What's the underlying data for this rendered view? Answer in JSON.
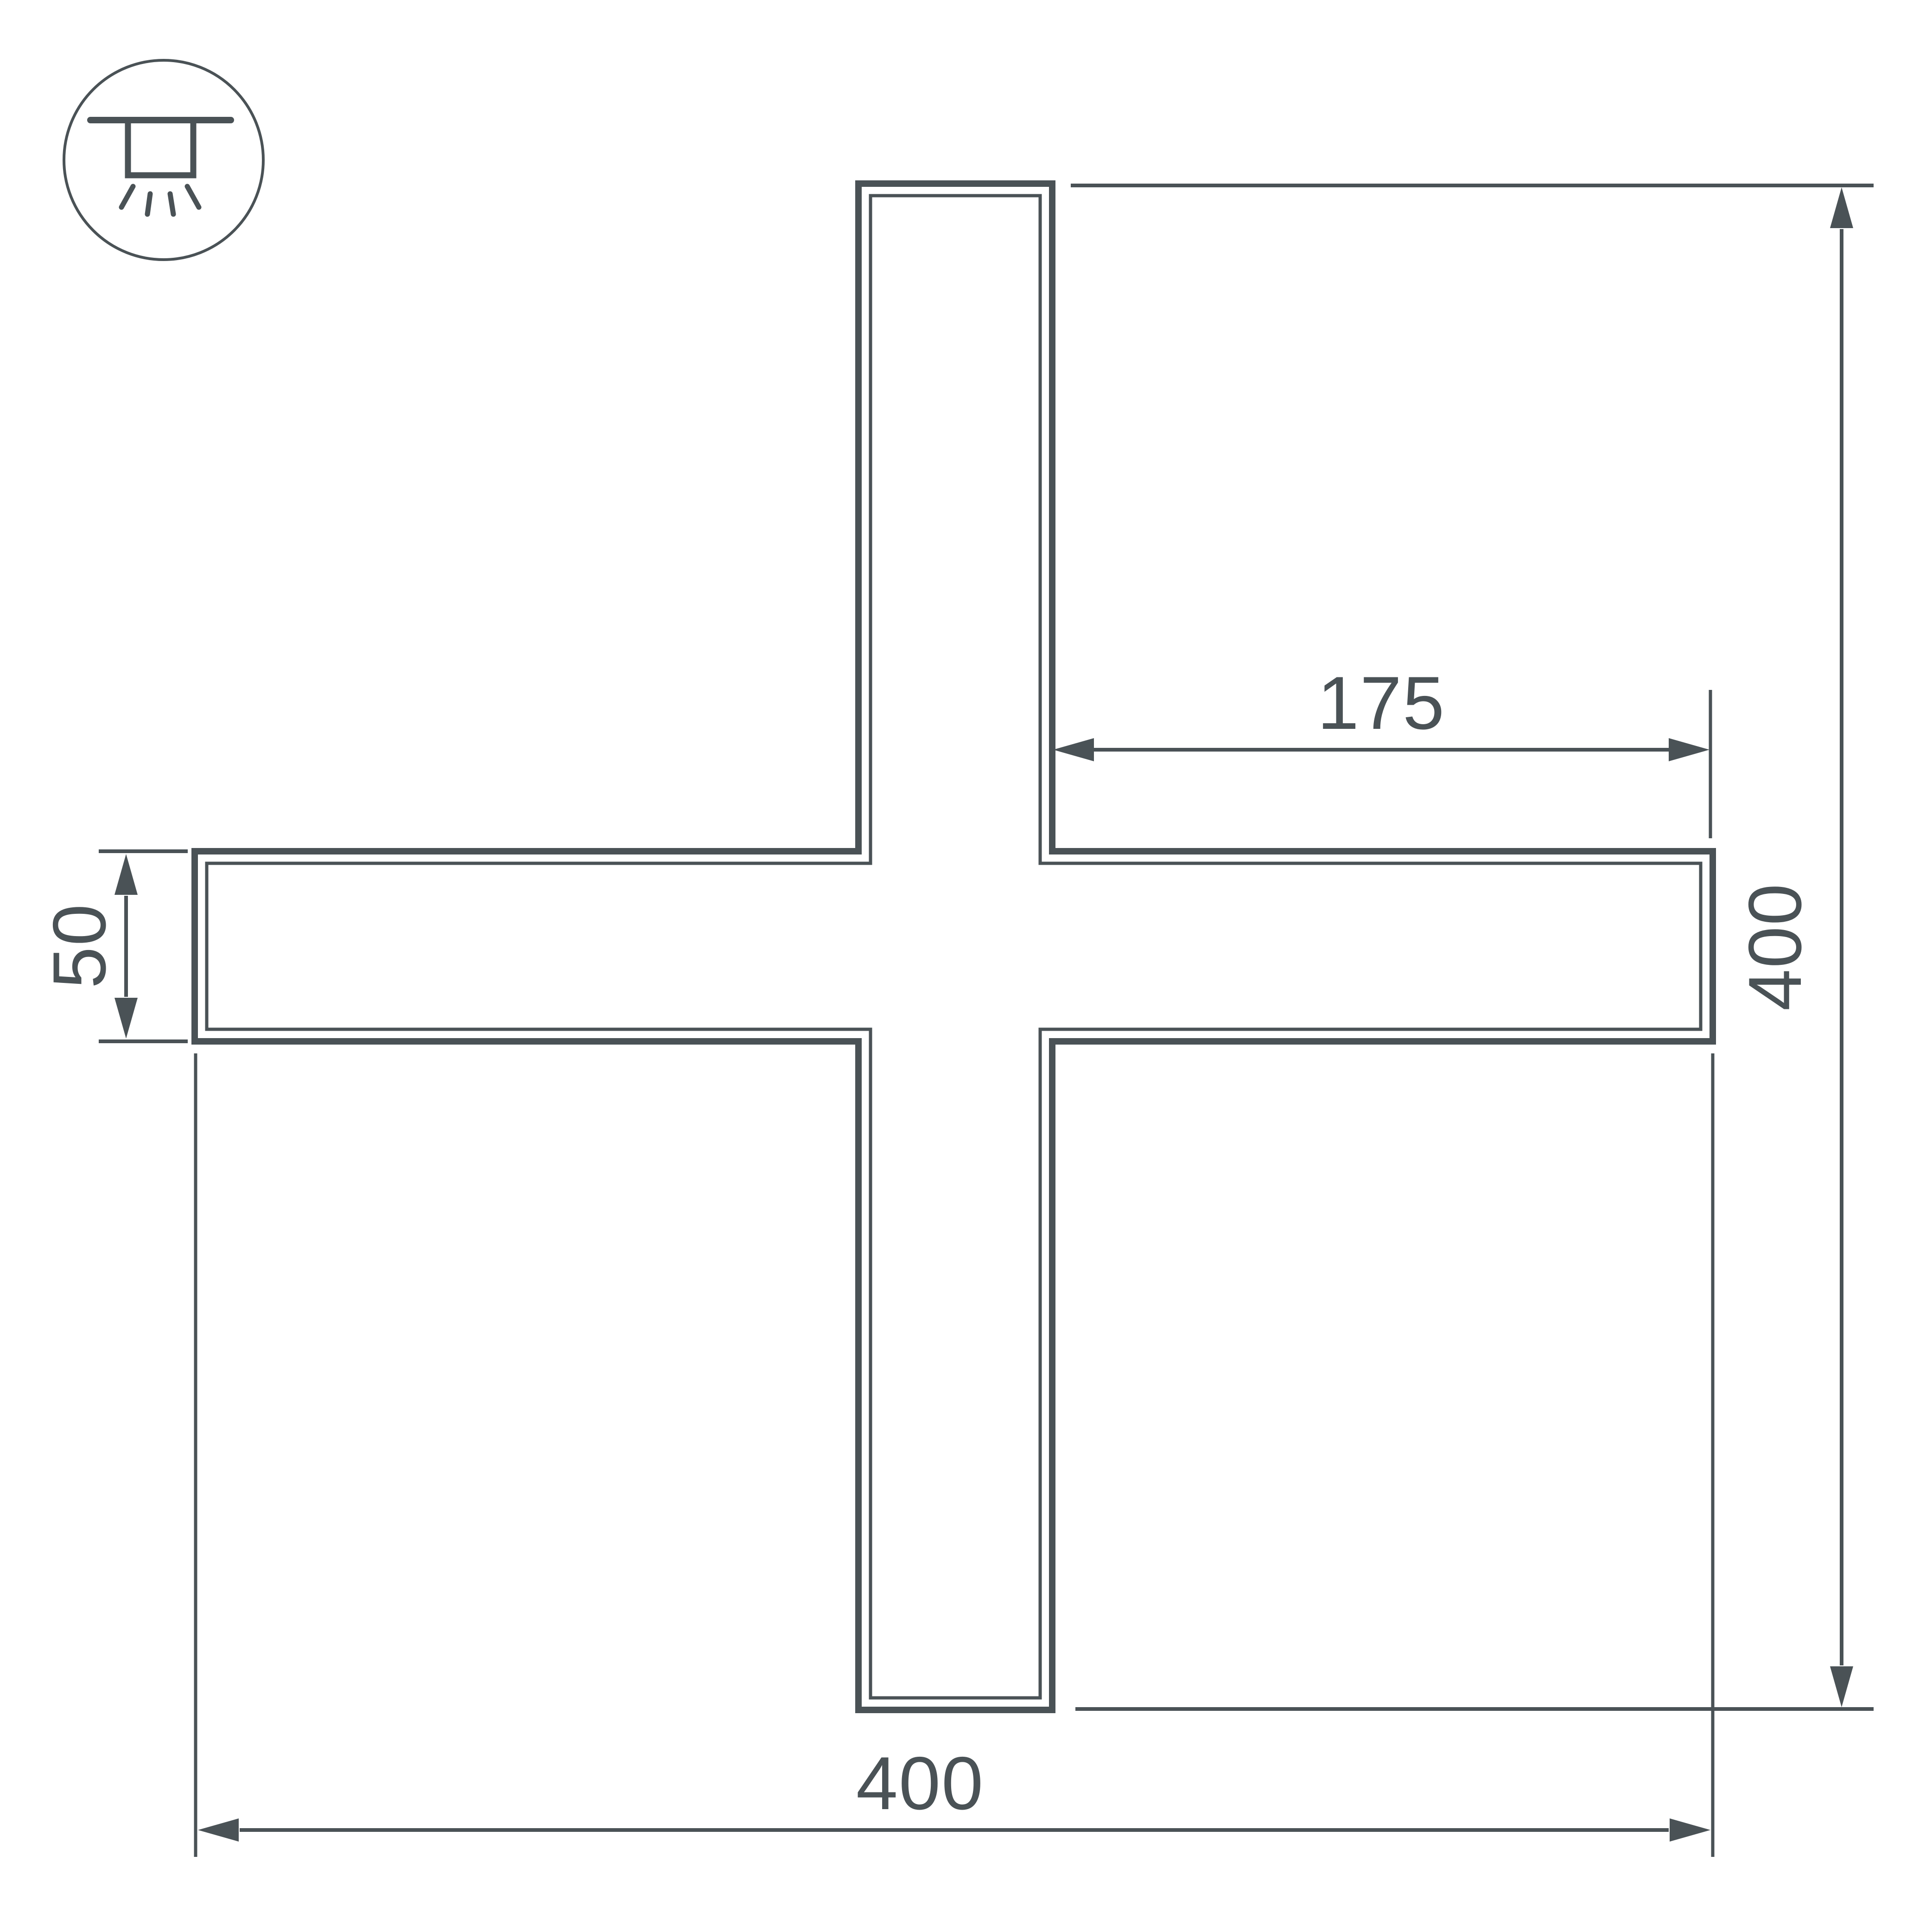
{
  "colors": {
    "line": "#4a5256",
    "background": "#ffffff"
  },
  "icon": {
    "name": "recessed-ceiling-light"
  },
  "dimensions": {
    "arm_right_length": "175",
    "overall_height": "400",
    "profile_width": "50",
    "overall_width": "400"
  }
}
